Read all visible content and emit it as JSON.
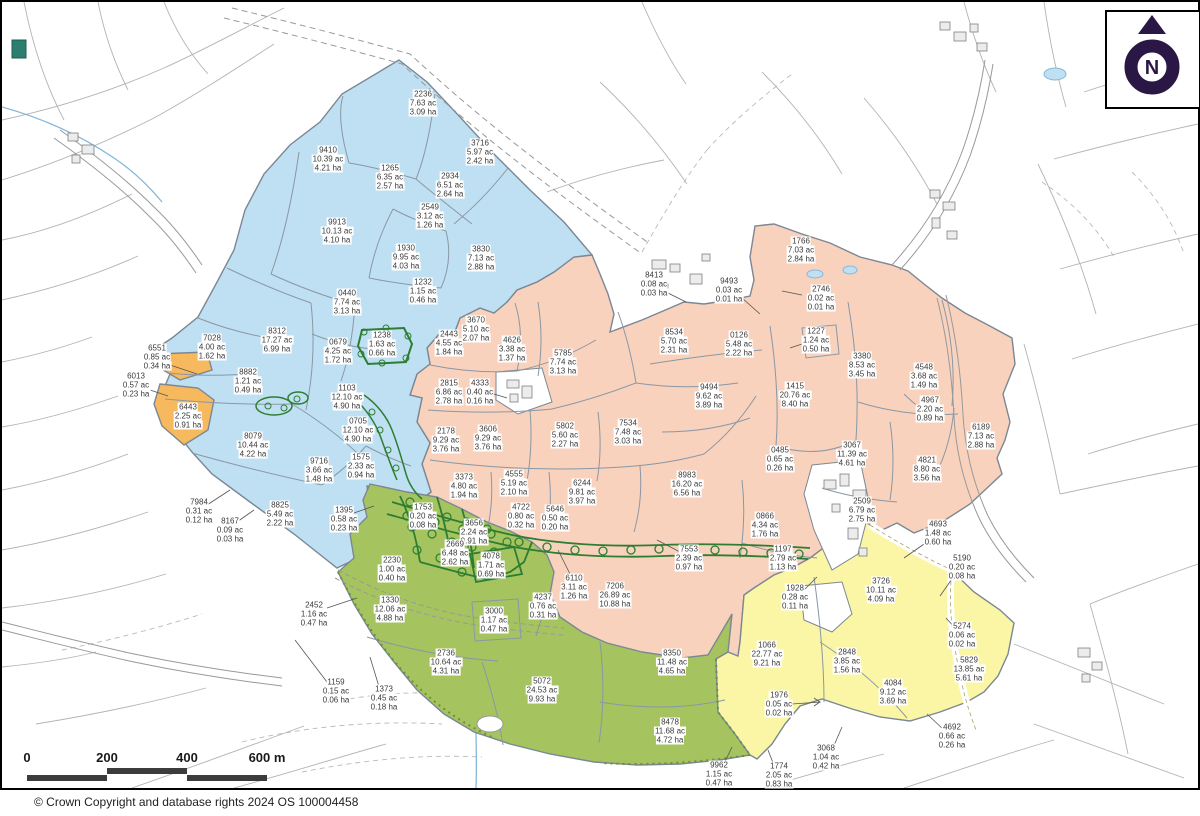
{
  "map": {
    "copyright": "© Crown Copyright and database rights 2024 OS 100004458",
    "north_label": "N",
    "scale": {
      "ticks": [
        "0",
        "200",
        "400",
        "600 m"
      ],
      "tick_spacing_px": 80
    },
    "colors": {
      "blue": "#bfe0f2",
      "pink": "#f8d2bd",
      "green": "#a5c45f",
      "yellow": "#faf6a6",
      "orange": "#f6b95e",
      "boundary": "#7b8794",
      "woodland": "#2d7d32",
      "north_arrow": "#2a1745",
      "water": "#85b8d8"
    },
    "parcels": [
      {
        "id": "2236",
        "ac": "7.63 ac",
        "ha": "3.09 ha",
        "x": 421,
        "y": 101,
        "group": "blue"
      },
      {
        "id": "3716",
        "ac": "5.97 ac",
        "ha": "2.42 ha",
        "x": 478,
        "y": 150,
        "group": "blue"
      },
      {
        "id": "9410",
        "ac": "10.39 ac",
        "ha": "4.21 ha",
        "x": 326,
        "y": 157,
        "group": "blue"
      },
      {
        "id": "1265",
        "ac": "6.35 ac",
        "ha": "2.57 ha",
        "x": 388,
        "y": 175,
        "group": "blue"
      },
      {
        "id": "2934",
        "ac": "6.51 ac",
        "ha": "2.64 ha",
        "x": 448,
        "y": 183,
        "group": "blue"
      },
      {
        "id": "2549",
        "ac": "3.12 ac",
        "ha": "1.26 ha",
        "x": 428,
        "y": 214,
        "group": "blue"
      },
      {
        "id": "9913",
        "ac": "10.13 ac",
        "ha": "4.10 ha",
        "x": 335,
        "y": 229,
        "group": "blue"
      },
      {
        "id": "1930",
        "ac": "9.95 ac",
        "ha": "4.03 ha",
        "x": 404,
        "y": 255,
        "group": "blue"
      },
      {
        "id": "3830",
        "ac": "7.13 ac",
        "ha": "2.88 ha",
        "x": 479,
        "y": 256,
        "group": "blue"
      },
      {
        "id": "0440",
        "ac": "7.74 ac",
        "ha": "3.13 ha",
        "x": 345,
        "y": 300,
        "group": "blue"
      },
      {
        "id": "1232",
        "ac": "1.15 ac",
        "ha": "0.46 ha",
        "x": 421,
        "y": 289,
        "group": "blue"
      },
      {
        "id": "7028",
        "ac": "4.00 ac",
        "ha": "1.62 ha",
        "x": 210,
        "y": 345,
        "group": "blue"
      },
      {
        "id": "8312",
        "ac": "17.27 ac",
        "ha": "6.99 ha",
        "x": 275,
        "y": 338,
        "group": "blue"
      },
      {
        "id": "0679",
        "ac": "4.25 ac",
        "ha": "1.72 ha",
        "x": 336,
        "y": 349,
        "group": "blue"
      },
      {
        "id": "1238",
        "ac": "1.63 ac",
        "ha": "0.66 ha",
        "x": 380,
        "y": 342,
        "group": "blue"
      },
      {
        "id": "8882",
        "ac": "1.21 ac",
        "ha": "0.49 ha",
        "x": 246,
        "y": 379,
        "group": "blue"
      },
      {
        "id": "1103",
        "ac": "12.10 ac",
        "ha": "4.90 ha",
        "x": 345,
        "y": 395,
        "group": "blue"
      },
      {
        "id": "0705",
        "ac": "12.10 ac",
        "ha": "4.90 ha",
        "x": 356,
        "y": 428,
        "group": "blue"
      },
      {
        "id": "8079",
        "ac": "10.44 ac",
        "ha": "4.22 ha",
        "x": 251,
        "y": 443,
        "group": "blue"
      },
      {
        "id": "9716",
        "ac": "3.66 ac",
        "ha": "1.48 ha",
        "x": 317,
        "y": 468,
        "group": "blue"
      },
      {
        "id": "1575",
        "ac": "2.33 ac",
        "ha": "0.94 ha",
        "x": 359,
        "y": 464,
        "group": "blue"
      },
      {
        "id": "8825",
        "ac": "5.49 ac",
        "ha": "2.22 ha",
        "x": 278,
        "y": 512,
        "group": "blue"
      },
      {
        "id": "6551",
        "ac": "0.85 ac",
        "ha": "0.34 ha",
        "x": 155,
        "y": 355,
        "group": "orange"
      },
      {
        "id": "6013",
        "ac": "0.57 ac",
        "ha": "0.23 ha",
        "x": 134,
        "y": 383,
        "group": "orange"
      },
      {
        "id": "6443",
        "ac": "2.25 ac",
        "ha": "0.91 ha",
        "x": 186,
        "y": 414,
        "group": "orange"
      },
      {
        "id": "7984",
        "ac": "0.31 ac",
        "ha": "0.12 ha",
        "x": 197,
        "y": 509,
        "group": "white"
      },
      {
        "id": "8167",
        "ac": "0.09 ac",
        "ha": "0.03 ha",
        "x": 228,
        "y": 528,
        "group": "white"
      },
      {
        "id": "1395",
        "ac": "0.58 ac",
        "ha": "0.23 ha",
        "x": 342,
        "y": 517,
        "group": "white"
      },
      {
        "id": "2452",
        "ac": "1.16 ac",
        "ha": "0.47 ha",
        "x": 312,
        "y": 612,
        "group": "white"
      },
      {
        "id": "1159",
        "ac": "0.15 ac",
        "ha": "0.06 ha",
        "x": 334,
        "y": 689,
        "group": "white"
      },
      {
        "id": "1373",
        "ac": "0.45 ac",
        "ha": "0.18 ha",
        "x": 382,
        "y": 696,
        "group": "white"
      },
      {
        "id": "8413",
        "ac": "0.08 ac",
        "ha": "0.03 ha",
        "x": 652,
        "y": 282,
        "group": "white"
      },
      {
        "id": "9493",
        "ac": "0.03 ac",
        "ha": "0.01 ha",
        "x": 727,
        "y": 288,
        "group": "white"
      },
      {
        "id": "9962",
        "ac": "1.15 ac",
        "ha": "0.47 ha",
        "x": 717,
        "y": 772,
        "group": "white"
      },
      {
        "id": "1774",
        "ac": "2.05 ac",
        "ha": "0.83 ha",
        "x": 777,
        "y": 773,
        "group": "white"
      },
      {
        "id": "3068",
        "ac": "1.04 ac",
        "ha": "0.42 ha",
        "x": 824,
        "y": 755,
        "group": "white"
      },
      {
        "id": "4693",
        "ac": "1.48 ac",
        "ha": "0.60 ha",
        "x": 936,
        "y": 531,
        "group": "white"
      },
      {
        "id": "5190",
        "ac": "0.20 ac",
        "ha": "0.08 ha",
        "x": 960,
        "y": 565,
        "group": "white"
      },
      {
        "id": "5274",
        "ac": "0.06 ac",
        "ha": "0.02 ha",
        "x": 960,
        "y": 633,
        "group": "white"
      },
      {
        "id": "4692",
        "ac": "0.66 ac",
        "ha": "0.26 ha",
        "x": 950,
        "y": 734,
        "group": "white"
      },
      {
        "id": "2443",
        "ac": "4.55 ac",
        "ha": "1.84 ha",
        "x": 447,
        "y": 341,
        "group": "pink"
      },
      {
        "id": "3670",
        "ac": "5.10 ac",
        "ha": "2.07 ha",
        "x": 474,
        "y": 327,
        "group": "pink"
      },
      {
        "id": "4626",
        "ac": "3.38 ac",
        "ha": "1.37 ha",
        "x": 510,
        "y": 347,
        "group": "pink"
      },
      {
        "id": "5785",
        "ac": "7.74 ac",
        "ha": "3.13 ha",
        "x": 561,
        "y": 360,
        "group": "pink"
      },
      {
        "id": "2815",
        "ac": "6.86 ac",
        "ha": "2.78 ha",
        "x": 447,
        "y": 390,
        "group": "pink"
      },
      {
        "id": "4333",
        "ac": "0.40 ac",
        "ha": "0.16 ha",
        "x": 478,
        "y": 390,
        "group": "pink"
      },
      {
        "id": "2178",
        "ac": "9.29 ac",
        "ha": "3.76 ha",
        "x": 444,
        "y": 438,
        "group": "pink"
      },
      {
        "id": "3606",
        "ac": "9.29 ac",
        "ha": "3.76 ha",
        "x": 486,
        "y": 436,
        "group": "pink"
      },
      {
        "id": "5802",
        "ac": "5.60 ac",
        "ha": "2.27 ha",
        "x": 563,
        "y": 433,
        "group": "pink"
      },
      {
        "id": "7534",
        "ac": "7.48 ac",
        "ha": "3.03 ha",
        "x": 626,
        "y": 430,
        "group": "pink"
      },
      {
        "id": "8534",
        "ac": "5.70 ac",
        "ha": "2.31 ha",
        "x": 672,
        "y": 339,
        "group": "pink"
      },
      {
        "id": "0126",
        "ac": "5.48 ac",
        "ha": "2.22 ha",
        "x": 737,
        "y": 342,
        "group": "pink"
      },
      {
        "id": "1227",
        "ac": "1.24 ac",
        "ha": "0.50 ha",
        "x": 814,
        "y": 338,
        "group": "pink"
      },
      {
        "id": "1766",
        "ac": "7.03 ac",
        "ha": "2.84 ha",
        "x": 799,
        "y": 248,
        "group": "pink"
      },
      {
        "id": "2746",
        "ac": "0.02 ac",
        "ha": "0.01 ha",
        "x": 819,
        "y": 296,
        "group": "pink"
      },
      {
        "id": "3380",
        "ac": "8.53 ac",
        "ha": "3.45 ha",
        "x": 860,
        "y": 363,
        "group": "pink"
      },
      {
        "id": "9494",
        "ac": "9.62 ac",
        "ha": "3.89 ha",
        "x": 707,
        "y": 394,
        "group": "pink"
      },
      {
        "id": "1415",
        "ac": "20.76 ac",
        "ha": "8.40 ha",
        "x": 793,
        "y": 393,
        "group": "pink"
      },
      {
        "id": "4548",
        "ac": "3.68 ac",
        "ha": "1.49 ha",
        "x": 922,
        "y": 374,
        "group": "pink"
      },
      {
        "id": "4967",
        "ac": "2.20 ac",
        "ha": "0.89 ha",
        "x": 928,
        "y": 407,
        "group": "pink"
      },
      {
        "id": "6189",
        "ac": "7.13 ac",
        "ha": "2.88 ha",
        "x": 979,
        "y": 434,
        "group": "pink"
      },
      {
        "id": "4821",
        "ac": "8.80 ac",
        "ha": "3.56 ha",
        "x": 925,
        "y": 467,
        "group": "pink"
      },
      {
        "id": "3067",
        "ac": "11.39 ac",
        "ha": "4.61 ha",
        "x": 850,
        "y": 452,
        "group": "pink"
      },
      {
        "id": "0485",
        "ac": "0.65 ac",
        "ha": "0.26 ha",
        "x": 778,
        "y": 457,
        "group": "pink"
      },
      {
        "id": "3373",
        "ac": "4.80 ac",
        "ha": "1.94 ha",
        "x": 462,
        "y": 484,
        "group": "pink"
      },
      {
        "id": "4555",
        "ac": "5.19 ac",
        "ha": "2.10 ha",
        "x": 512,
        "y": 481,
        "group": "pink"
      },
      {
        "id": "6244",
        "ac": "9.81 ac",
        "ha": "3.97 ha",
        "x": 580,
        "y": 490,
        "group": "pink"
      },
      {
        "id": "4722",
        "ac": "0.80 ac",
        "ha": "0.32 ha",
        "x": 519,
        "y": 514,
        "group": "pink"
      },
      {
        "id": "5646",
        "ac": "0.50 ac",
        "ha": "0.20 ha",
        "x": 553,
        "y": 516,
        "group": "pink"
      },
      {
        "id": "8983",
        "ac": "16.20 ac",
        "ha": "6.56 ha",
        "x": 685,
        "y": 482,
        "group": "pink"
      },
      {
        "id": "0866",
        "ac": "4.34 ac",
        "ha": "1.76 ha",
        "x": 763,
        "y": 523,
        "group": "pink"
      },
      {
        "id": "1197",
        "ac": "2.79 ac",
        "ha": "1.13 ha",
        "x": 781,
        "y": 556,
        "group": "pink"
      },
      {
        "id": "2509",
        "ac": "6.79 ac",
        "ha": "2.75 ha",
        "x": 860,
        "y": 508,
        "group": "pink"
      },
      {
        "id": "6110",
        "ac": "3.11 ac",
        "ha": "1.26 ha",
        "x": 572,
        "y": 585,
        "group": "pink"
      },
      {
        "id": "7206",
        "ac": "26.89 ac",
        "ha": "10.88 ha",
        "x": 613,
        "y": 593,
        "group": "pink"
      },
      {
        "id": "7553",
        "ac": "2.39 ac",
        "ha": "0.97 ha",
        "x": 687,
        "y": 556,
        "group": "pink"
      },
      {
        "id": "1753",
        "ac": "0.20 ac",
        "ha": "0.08 ha",
        "x": 421,
        "y": 514,
        "group": "green"
      },
      {
        "id": "3656",
        "ac": "2.24 ac",
        "ha": "0.91 ha",
        "x": 472,
        "y": 530,
        "group": "green"
      },
      {
        "id": "2669",
        "ac": "6.48 ac",
        "ha": "2.62 ha",
        "x": 453,
        "y": 551,
        "group": "green"
      },
      {
        "id": "4078",
        "ac": "1.71 ac",
        "ha": "0.69 ha",
        "x": 489,
        "y": 563,
        "group": "green"
      },
      {
        "id": "2230",
        "ac": "1.00 ac",
        "ha": "0.40 ha",
        "x": 390,
        "y": 567,
        "group": "green"
      },
      {
        "id": "1330",
        "ac": "12.06 ac",
        "ha": "4.88 ha",
        "x": 388,
        "y": 607,
        "group": "green"
      },
      {
        "id": "3000",
        "ac": "1.17 ac",
        "ha": "0.47 ha",
        "x": 492,
        "y": 618,
        "group": "green"
      },
      {
        "id": "4237",
        "ac": "0.76 ac",
        "ha": "0.31 ha",
        "x": 541,
        "y": 604,
        "group": "green"
      },
      {
        "id": "2736",
        "ac": "10.64 ac",
        "ha": "4.31 ha",
        "x": 444,
        "y": 660,
        "group": "green"
      },
      {
        "id": "5072",
        "ac": "24.53 ac",
        "ha": "9.93 ha",
        "x": 540,
        "y": 688,
        "group": "green"
      },
      {
        "id": "8350",
        "ac": "11.48 ac",
        "ha": "4.65 ha",
        "x": 670,
        "y": 660,
        "group": "green"
      },
      {
        "id": "8478",
        "ac": "11.68 ac",
        "ha": "4.72 ha",
        "x": 668,
        "y": 729,
        "group": "green"
      },
      {
        "id": "1928",
        "ac": "0.28 ac",
        "ha": "0.11 ha",
        "x": 793,
        "y": 595,
        "group": "yellow"
      },
      {
        "id": "1066",
        "ac": "22.77 ac",
        "ha": "9.21 ha",
        "x": 765,
        "y": 652,
        "group": "yellow"
      },
      {
        "id": "1976",
        "ac": "0.05 ac",
        "ha": "0.02 ha",
        "x": 777,
        "y": 702,
        "group": "yellow"
      },
      {
        "id": "2848",
        "ac": "3.85 ac",
        "ha": "1.56 ha",
        "x": 845,
        "y": 659,
        "group": "yellow"
      },
      {
        "id": "4084",
        "ac": "9.12 ac",
        "ha": "3.69 ha",
        "x": 891,
        "y": 690,
        "group": "yellow"
      },
      {
        "id": "3726",
        "ac": "10.11 ac",
        "ha": "4.09 ha",
        "x": 879,
        "y": 588,
        "group": "yellow"
      },
      {
        "id": "5829",
        "ac": "13.85 ac",
        "ha": "5.61 ha",
        "x": 967,
        "y": 667,
        "group": "yellow"
      }
    ]
  }
}
